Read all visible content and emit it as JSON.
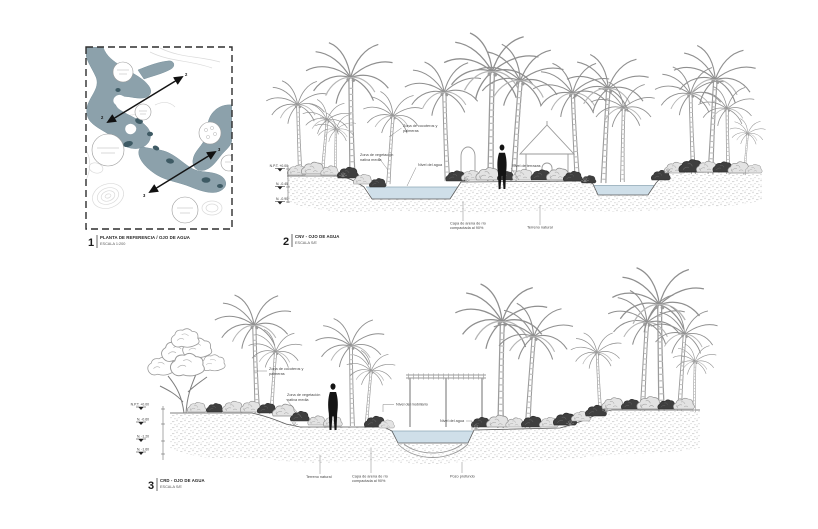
{
  "colors": {
    "map_water": "#8CA1AB",
    "map_water_dark": "#3E5A64",
    "section_water": "#CFDFE9"
  },
  "panels": {
    "p1": {
      "num": "1",
      "title": "PLANTA DE REFERENCIA / OJO DE AGUA",
      "scale": "ESCALA 1:200"
    },
    "p2": {
      "num": "2",
      "title": "CNV - OJO DE AGUA",
      "scale": "ESCALA S/E"
    },
    "p3": {
      "num": "3",
      "title": "CRD - OJO DE AGUA",
      "scale": "ESCALA S/E"
    }
  },
  "map": {
    "cut_a": "2",
    "cut_b": "3"
  },
  "s2": {
    "zona_palmeras_1": "Zona de cocoteros y",
    "zona_palmeras_2": "palmeras",
    "zona_veg_1": "Zona de vegetación",
    "zona_veg_2": "nativa media",
    "nivel_agua": "Nivel del agua",
    "nivel_terrazas": "Nivel de terrazas",
    "capa_arena_1": "Capa de arena de río",
    "capa_arena_2": "compactada al 90%",
    "terreno": "Terreno natural",
    "levels": [
      "N.P.T. +0.00",
      "N. -0.45",
      "N. -0.90"
    ]
  },
  "s3": {
    "zona_palmeras_1": "Zona de cocoteros y",
    "zona_palmeras_2": "palmeras",
    "zona_veg_1": "Zona de vegetación",
    "zona_veg_2": "nativa media",
    "nivel_mobiliario": "Nivel del mobiliario",
    "nivel_agua": "Nivel del agua",
    "terreno": "Terreno natural",
    "capa_arena_1": "Capa de arena de río",
    "capa_arena_2": "compactada al 90%",
    "pozo": "Pozo profundo",
    "levels": [
      "N.P.T. +0.00",
      "N. -0.60",
      "N. -1.20",
      "N. -1.60"
    ]
  }
}
